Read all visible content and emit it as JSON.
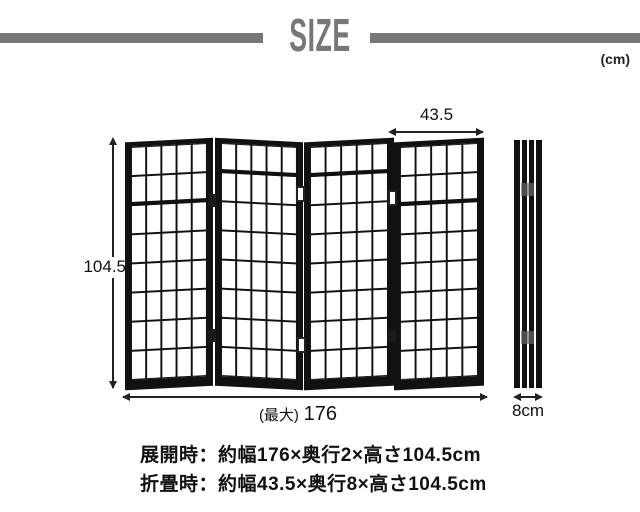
{
  "header": {
    "title": "SIZE",
    "unit_note": "(cm)"
  },
  "dimensions": {
    "height": "104.5",
    "panel_width": "43.5",
    "total_width_prefix": "(最大)",
    "total_width_value": "176",
    "folded_depth": "8cm"
  },
  "screen": {
    "panel_count": 4,
    "grid_columns": 5,
    "grid_rows": 8
  },
  "specs": {
    "expanded": "展開時：約幅176×奥行2×高さ104.5cm",
    "folded": "折畳時：約幅43.5×奥行8×高さ104.5cm"
  },
  "colors": {
    "accent_gray": "#777777",
    "frame_black": "#111111"
  }
}
